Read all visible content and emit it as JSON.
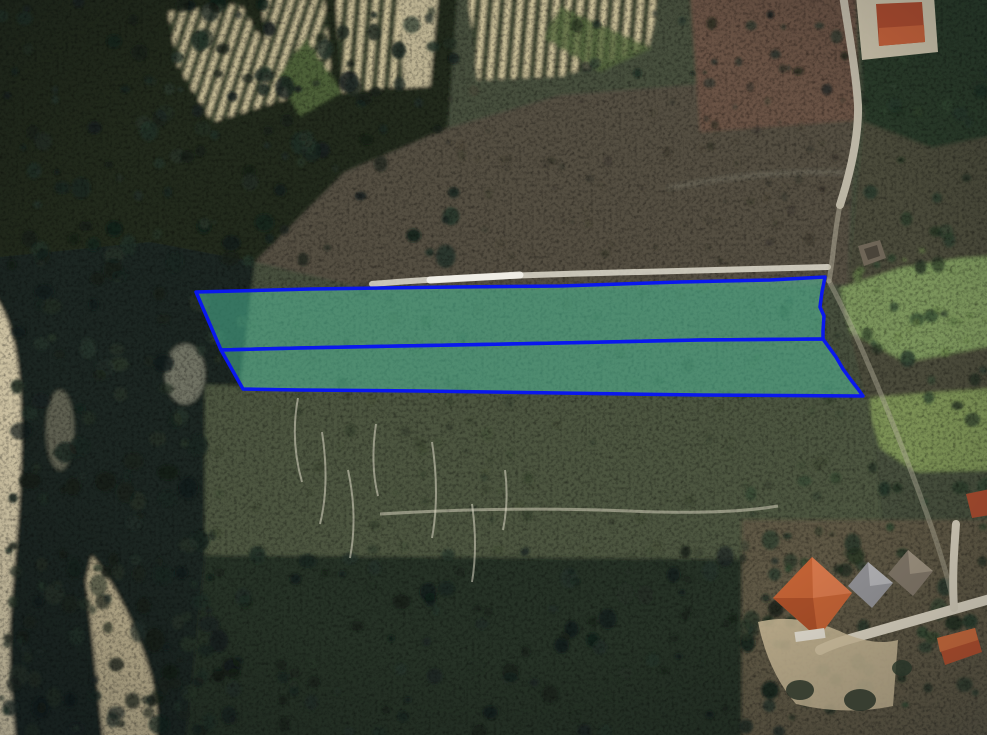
{
  "map": {
    "description": "aerial-satellite-view-with-highlighted-land-parcels",
    "canvas": {
      "width": 987,
      "height": 735
    },
    "overlay": {
      "stroke_color": "#0a18ee",
      "stroke_width": 3.5,
      "fill_color": "rgba(88,214,176,0.45)",
      "parcels": [
        {
          "name": "upper-parcel",
          "points": "196,292 310,289 455,287 560,286 680,282 770,280 825,277 822,292 820,307 824,316 823,331 823,339 700,340 560,343 400,346 300,348 221,350"
        },
        {
          "name": "lower-parcel",
          "points": "221,350 300,348 400,346 560,343 700,340 823,339 828,346 836,357 843,369 851,380 858,389 863,396 700,395 560,393 420,391 300,390 243,389"
        }
      ]
    },
    "palette": {
      "base_olive": "#47503c",
      "forest_dark": "#20291f",
      "forest_deep": "#1c2621",
      "scrub_gray": "#554f42",
      "red_brown": "#6a5244",
      "top_right_green": "#2c3a2a",
      "right_band": "#4c4c3a",
      "meadow_green": "#7c955c",
      "meadow_green2": "#7b9154",
      "field_band": "#4e5640",
      "bottom_dark": "#273126",
      "house_zone": "#5f5844",
      "scree_beige": "#d5c9a8",
      "scree_beige2": "#cabb97",
      "vineyard_stripe": "#d8cba2",
      "vineyard_ground": "#39422f",
      "road_gray": "#c2bcab",
      "dirt_light": "#c8b795",
      "trail_white": "#e7e4d6",
      "roof_orange": "#c06134",
      "roof_orange_light": "#d3764a",
      "roof_red_dark": "#a84a2e",
      "roof_gray": "#909094",
      "roof_brown": "#7e7466"
    }
  }
}
